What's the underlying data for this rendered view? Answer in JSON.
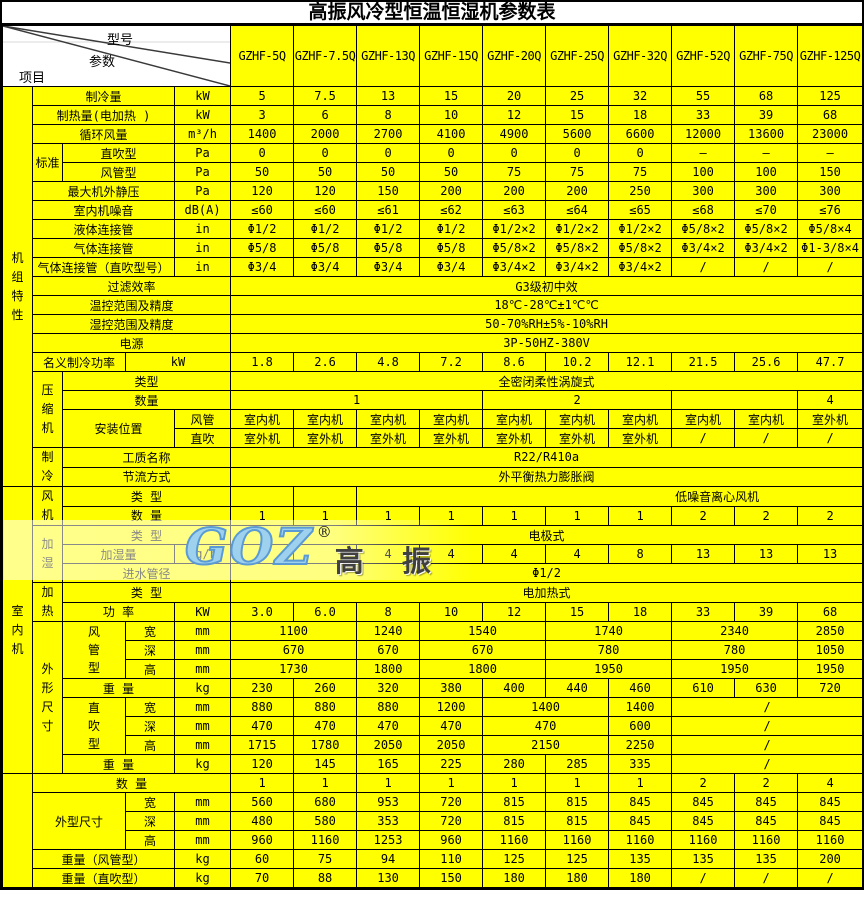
{
  "title": "高振风冷型恒温恒湿机参数表",
  "corner": {
    "model": "型号",
    "param": "参数",
    "item": "项目"
  },
  "models": [
    "GZHF-5Q",
    "GZHF-7.5Q",
    "GZHF-13Q",
    "GZHF-15Q",
    "GZHF-20Q",
    "GZHF-25Q",
    "GZHF-32Q",
    "GZHF-52Q",
    "GZHF-75Q",
    "GZHF-125Q"
  ],
  "logo": {
    "latin": "GOZ",
    "reg": "®",
    "cn": "高 振"
  },
  "colors": {
    "table_bg": "#ffff00",
    "border": "#000000",
    "header_bg": "#ffffff",
    "logo_blue": "#9ed1ee",
    "logo_blue_edge": "#5b9bd5",
    "logo_gray": "#404040"
  },
  "rows": [
    [
      {
        "t": "机组特性",
        "rs": 21,
        "c": "vlab",
        "v": 1,
        "n": "section-label-unit-characteristics"
      },
      {
        "t": "制冷量",
        "cs": 3,
        "c": "lab"
      },
      {
        "t": "kW",
        "c": "unit"
      },
      "5",
      "7.5",
      "13",
      "15",
      "20",
      "25",
      "32",
      "55",
      "68",
      "125"
    ],
    [
      {
        "t": "制热量(电加热 )",
        "cs": 3,
        "c": "lab"
      },
      {
        "t": "kW",
        "c": "unit"
      },
      "3",
      "6",
      "8",
      "10",
      "12",
      "15",
      "18",
      "33",
      "39",
      "68"
    ],
    [
      {
        "t": "循环风量",
        "cs": 3,
        "c": "lab"
      },
      {
        "t": "m³/h",
        "c": "unit"
      },
      "1400",
      "2000",
      "2700",
      "4100",
      "4900",
      "5600",
      "6600",
      "12000",
      "13600",
      "23000"
    ],
    [
      {
        "t": "标准",
        "rs": 2,
        "c": "lab"
      },
      {
        "t": "直吹型",
        "cs": 2,
        "c": "lab"
      },
      {
        "t": "Pa",
        "c": "unit"
      },
      "0",
      "0",
      "0",
      "0",
      "0",
      "0",
      "0",
      "–",
      "–",
      "–"
    ],
    [
      {
        "t": "风管型",
        "cs": 2,
        "c": "lab"
      },
      {
        "t": "Pa",
        "c": "unit"
      },
      "50",
      "50",
      "50",
      "50",
      "75",
      "75",
      "75",
      "100",
      "100",
      "150"
    ],
    [
      {
        "t": "最大机外静压",
        "cs": 3,
        "c": "lab"
      },
      {
        "t": "Pa",
        "c": "unit"
      },
      "120",
      "120",
      "150",
      "200",
      "200",
      "200",
      "250",
      "300",
      "300",
      "300"
    ],
    [
      {
        "t": "室内机噪音",
        "cs": 3,
        "c": "lab"
      },
      {
        "t": "dB(A)",
        "c": "unit"
      },
      "≤60",
      "≤60",
      "≤61",
      "≤62",
      "≤63",
      "≤64",
      "≤65",
      "≤68",
      "≤70",
      "≤76"
    ],
    [
      {
        "t": "液体连接管",
        "cs": 3,
        "c": "lab"
      },
      {
        "t": "in",
        "c": "unit"
      },
      "Φ1/2",
      "Φ1/2",
      "Φ1/2",
      "Φ1/2",
      "Φ1/2×2",
      "Φ1/2×2",
      "Φ1/2×2",
      "Φ5/8×2",
      "Φ5/8×2",
      "Φ5/8×4"
    ],
    [
      {
        "t": "气体连接管",
        "cs": 3,
        "c": "lab"
      },
      {
        "t": "in",
        "c": "unit"
      },
      "Φ5/8",
      "Φ5/8",
      "Φ5/8",
      "Φ5/8",
      "Φ5/8×2",
      "Φ5/8×2",
      "Φ5/8×2",
      "Φ3/4×2",
      "Φ3/4×2",
      "Φ1-3/8×4"
    ],
    [
      {
        "t": "气体连接管（直吹型号）",
        "cs": 3,
        "c": "lab"
      },
      {
        "t": "in",
        "c": "unit"
      },
      "Φ3/4",
      "Φ3/4",
      "Φ3/4",
      "Φ3/4",
      "Φ3/4×2",
      "Φ3/4×2",
      "Φ3/4×2",
      "/",
      "/",
      "/"
    ],
    [
      {
        "t": "过滤效率",
        "cs": 4,
        "c": "lab"
      },
      {
        "t": "G3级初中效",
        "cs": 10
      }
    ],
    [
      {
        "t": "温控范围及精度",
        "cs": 4,
        "c": "lab"
      },
      {
        "t": "18℃-28℃±1℃℃",
        "cs": 10
      }
    ],
    [
      {
        "t": "湿控范围及精度",
        "cs": 4,
        "c": "lab"
      },
      {
        "t": "50-70%RH±5%-10%RH",
        "cs": 10
      }
    ],
    [
      {
        "t": "电源",
        "cs": 4,
        "c": "lab"
      },
      {
        "t": "3P-50HZ-380V",
        "cs": 10
      }
    ],
    [
      {
        "t": "名义制冷功率",
        "cs": 2,
        "c": "lab"
      },
      {
        "t": "kW",
        "cs": 2,
        "c": "unit"
      },
      "1.8",
      "2.6",
      "4.8",
      "7.2",
      "8.6",
      "10.2",
      "12.1",
      "21.5",
      "25.6",
      "47.7"
    ],
    [
      {
        "t": "压缩机",
        "rs": 4,
        "c": "vlab",
        "v": 1,
        "n": "section-label-compressor"
      },
      {
        "t": "类型",
        "cs": 3,
        "c": "lab"
      },
      {
        "t": "全密闭柔性涡旋式",
        "cs": 10
      }
    ],
    [
      {
        "t": "数量",
        "cs": 3,
        "c": "lab"
      },
      {
        "t": "1",
        "cs": 4
      },
      {
        "t": "2",
        "cs": 3
      },
      {
        "t": "",
        "cs": 2
      },
      "4"
    ],
    [
      {
        "t": "安装位置",
        "cs": 2,
        "rs": 2,
        "c": "lab"
      },
      {
        "t": "风管",
        "c": "unit"
      },
      "室内机",
      "室内机",
      "室内机",
      "室内机",
      "室内机",
      "室内机",
      "室内机",
      "室内机",
      "室内机",
      "室外机"
    ],
    [
      {
        "t": "直吹",
        "c": "unit"
      },
      "室外机",
      "室外机",
      "室外机",
      "室外机",
      "室外机",
      "室外机",
      "室外机",
      "/",
      "/",
      "/"
    ],
    [
      {
        "t": "制冷",
        "rs": 2,
        "c": "vlab",
        "v": 1,
        "n": "section-label-refrigeration"
      },
      {
        "t": "工质名称",
        "cs": 3,
        "c": "lab"
      },
      {
        "t": "R22/R410a",
        "cs": 10
      }
    ],
    [
      {
        "t": "节流方式",
        "cs": 3,
        "c": "lab"
      },
      {
        "t": "外平衡热力膨胀阀",
        "cs": 10
      }
    ],
    [
      {
        "t": "室内机",
        "rs": 15,
        "c": "vlab",
        "v": 1,
        "n": "section-label-indoor-unit"
      },
      {
        "t": "风机",
        "rs": 2,
        "c": "vlab",
        "v": 1,
        "n": "section-label-fan"
      },
      {
        "t": "类 型",
        "cs": 3,
        "c": "lab"
      },
      "",
      "",
      {
        "t": "低噪音离心风机",
        "cs": 8,
        "c": "padl"
      }
    ],
    [
      {
        "t": "数 量",
        "cs": 3,
        "c": "lab"
      },
      "1",
      "1",
      "1",
      "1",
      "1",
      "1",
      "1",
      "2",
      "2",
      "2"
    ],
    [
      {
        "t": "加湿",
        "rs": 3,
        "c": "vlab",
        "v": 1,
        "n": "section-label-humidification"
      },
      {
        "t": "类 型",
        "cs": 3,
        "c": "lab"
      },
      {
        "t": "电极式",
        "cs": 10
      }
    ],
    [
      {
        "t": "加湿量",
        "cs": 2,
        "c": "lab"
      },
      {
        "t": "kg/h",
        "c": "unit"
      },
      "3",
      "",
      "4",
      "4",
      "4",
      "4",
      "8",
      "13",
      "13",
      "13"
    ],
    [
      {
        "t": "进水管径",
        "cs": 3,
        "c": "lab"
      },
      {
        "t": "Φ1/2",
        "cs": 10
      }
    ],
    [
      {
        "t": "加热",
        "rs": 2,
        "c": "vlab",
        "v": 1,
        "n": "section-label-heating"
      },
      {
        "t": "类 型",
        "cs": 3,
        "c": "lab"
      },
      {
        "t": "电加热式",
        "cs": 10
      }
    ],
    [
      {
        "t": "功 率",
        "cs": 2,
        "c": "lab"
      },
      {
        "t": "KW",
        "c": "unit"
      },
      "3.0",
      "6.0",
      "8",
      "10",
      "12",
      "15",
      "18",
      "33",
      "39",
      "68"
    ],
    [
      {
        "t": "外形尺寸",
        "rs": 8,
        "c": "vlab",
        "v": 1,
        "n": "section-label-dimensions"
      },
      {
        "t": "风管型",
        "rs": 3,
        "c": "lab",
        "v": 1
      },
      {
        "t": "宽",
        "c": "lab"
      },
      {
        "t": "mm",
        "c": "unit"
      },
      {
        "t": "1100",
        "cs": 2
      },
      "1240",
      {
        "t": "1540",
        "cs": 2
      },
      {
        "t": "1740",
        "cs": 2
      },
      {
        "t": "2340",
        "cs": 2
      },
      "2850"
    ],
    [
      {
        "t": "深",
        "c": "lab"
      },
      {
        "t": "mm",
        "c": "unit"
      },
      {
        "t": "670",
        "cs": 2
      },
      "670",
      {
        "t": "670",
        "cs": 2
      },
      {
        "t": "780",
        "cs": 2
      },
      {
        "t": "780",
        "cs": 2
      },
      "1050"
    ],
    [
      {
        "t": "高",
        "c": "lab"
      },
      {
        "t": "mm",
        "c": "unit"
      },
      {
        "t": "1730",
        "cs": 2
      },
      "1800",
      {
        "t": "1800",
        "cs": 2
      },
      {
        "t": "1950",
        "cs": 2
      },
      {
        "t": "1950",
        "cs": 2
      },
      "1950"
    ],
    [
      {
        "t": "重 量",
        "cs": 2,
        "c": "lab"
      },
      {
        "t": "kg",
        "c": "unit"
      },
      "230",
      "260",
      "320",
      "380",
      "400",
      "440",
      "460",
      "610",
      "630",
      "720"
    ],
    [
      {
        "t": "直吹型",
        "rs": 3,
        "c": "lab",
        "v": 1
      },
      {
        "t": "宽",
        "c": "lab"
      },
      {
        "t": "mm",
        "c": "unit"
      },
      "880",
      "880",
      "880",
      "1200",
      {
        "t": "1400",
        "cs": 2
      },
      "1400",
      {
        "t": "/",
        "cs": 3
      }
    ],
    [
      {
        "t": "深",
        "c": "lab"
      },
      {
        "t": "mm",
        "c": "unit"
      },
      "470",
      "470",
      "470",
      "470",
      {
        "t": "470",
        "cs": 2
      },
      "600",
      {
        "t": "/",
        "cs": 3
      }
    ],
    [
      {
        "t": "高",
        "c": "lab"
      },
      {
        "t": "mm",
        "c": "unit"
      },
      "1715",
      "1780",
      "2050",
      "2050",
      {
        "t": "2150",
        "cs": 2
      },
      "2250",
      {
        "t": "/",
        "cs": 3
      }
    ],
    [
      {
        "t": "重 量",
        "cs": 2,
        "c": "lab"
      },
      {
        "t": "kg",
        "c": "unit"
      },
      "120",
      "145",
      "165",
      "225",
      "280",
      "285",
      "335",
      {
        "t": "/",
        "cs": 3
      }
    ],
    [
      {
        "t": "",
        "rs": 6,
        "c": "vlab",
        "n": "section-label-outdoor-blank"
      },
      {
        "t": "数 量",
        "cs": 4,
        "c": "lab"
      },
      "1",
      "1",
      "1",
      "1",
      "1",
      "1",
      "1",
      "2",
      "2",
      "4"
    ],
    [
      {
        "t": "外型尺寸",
        "cs": 2,
        "rs": 3,
        "c": "lab"
      },
      {
        "t": "宽",
        "c": "lab"
      },
      {
        "t": "mm",
        "c": "unit"
      },
      "560",
      "680",
      "953",
      "720",
      "815",
      "815",
      "845",
      "845",
      "845",
      "845"
    ],
    [
      {
        "t": "深",
        "c": "lab"
      },
      {
        "t": "mm",
        "c": "unit"
      },
      "480",
      "580",
      "353",
      "720",
      "815",
      "815",
      "845",
      "845",
      "845",
      "845"
    ],
    [
      {
        "t": "高",
        "c": "lab"
      },
      {
        "t": "mm",
        "c": "unit"
      },
      "960",
      "1160",
      "1253",
      "960",
      "1160",
      "1160",
      "1160",
      "1160",
      "1160",
      "1160"
    ],
    [
      {
        "t": "重量（风管型）",
        "cs": 3,
        "c": "lab"
      },
      {
        "t": "kg",
        "c": "unit"
      },
      "60",
      "75",
      "94",
      "110",
      "125",
      "125",
      "135",
      "135",
      "135",
      "200"
    ],
    [
      {
        "t": "重量（直吹型）",
        "cs": 3,
        "c": "lab"
      },
      {
        "t": "kg",
        "c": "unit"
      },
      "70",
      "88",
      "130",
      "150",
      "180",
      "180",
      "180",
      "/",
      "/",
      "/"
    ]
  ]
}
